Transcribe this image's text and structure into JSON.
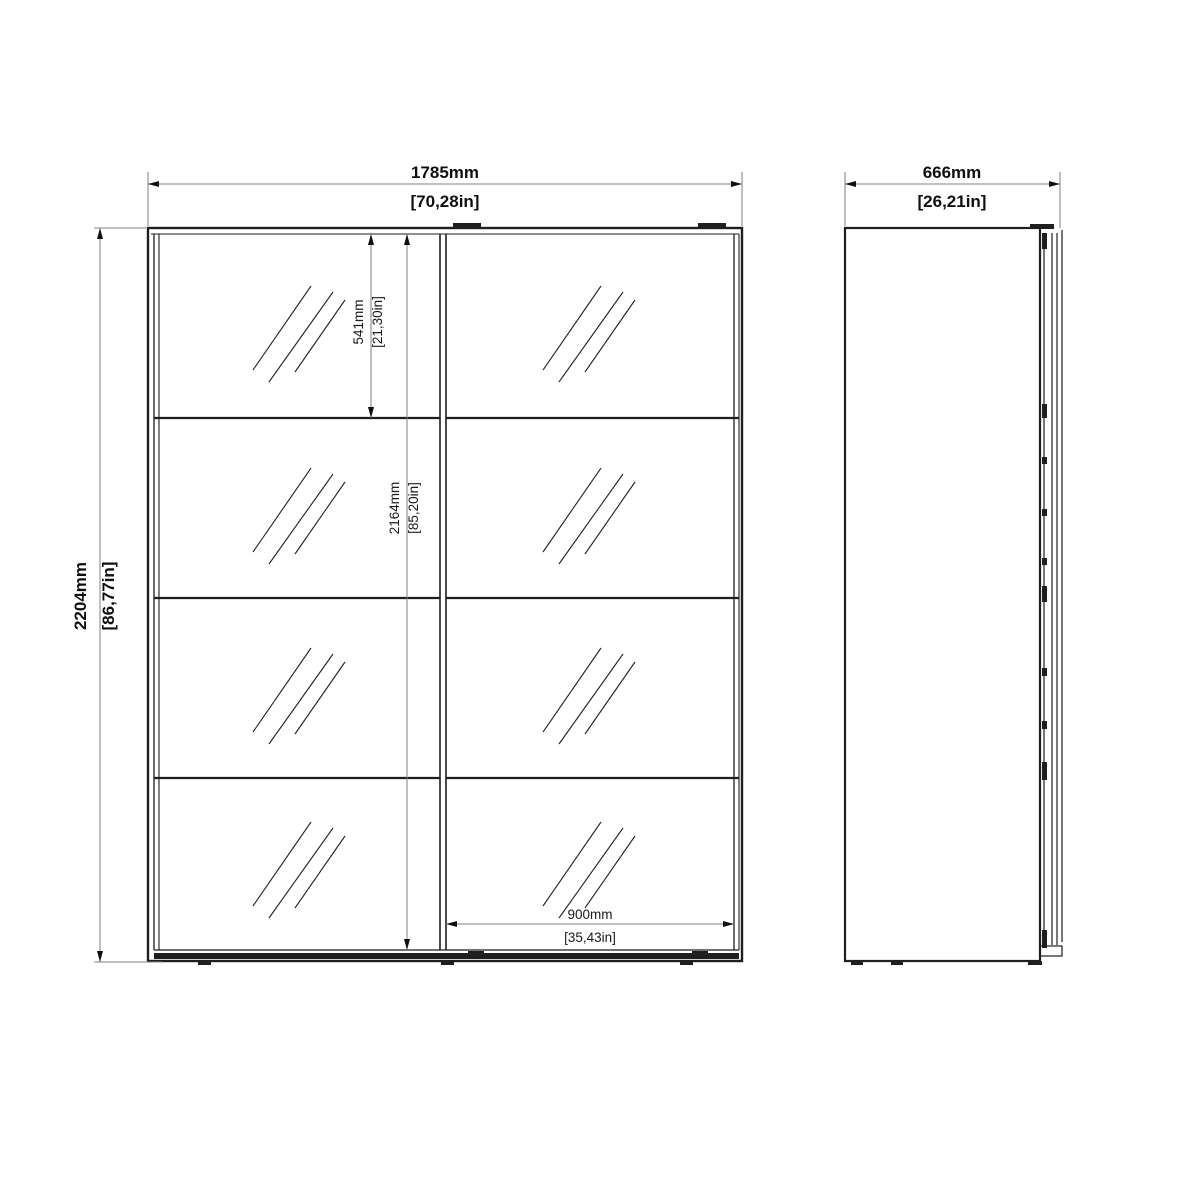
{
  "title": "Sliding wardrobe dimension drawing",
  "front_view": {
    "width_mm": "1785mm",
    "width_in": "[70,28in]",
    "height_mm": "2204mm",
    "height_in": "[86,77in]",
    "top_section_mm": "541mm",
    "top_section_in": "[21,30in]",
    "door_height_mm": "2164mm",
    "door_height_in": "[85,20in]",
    "door_width_mm": "900mm",
    "door_width_in": "[35,43in]"
  },
  "side_view": {
    "depth_mm": "666mm",
    "depth_in": "[26,21in]"
  },
  "colors": {
    "structure_line": "#1f1f1f",
    "dimension_line": "#828282",
    "text": "#0f0f0f",
    "background": "#ffffff"
  }
}
